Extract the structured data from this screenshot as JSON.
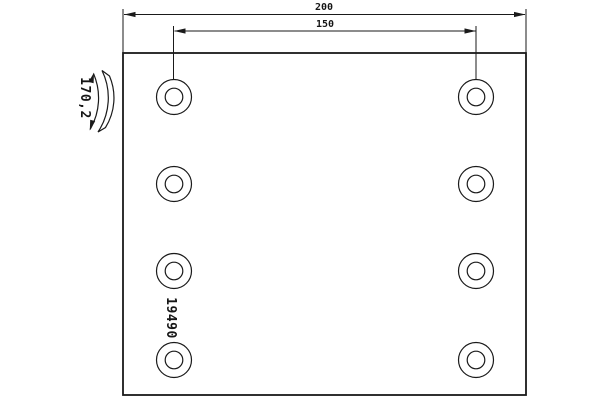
{
  "window": {
    "background": "#ffffff"
  },
  "drawing": {
    "line_color": "#1a1a1a",
    "labels": {
      "overall_width": "200",
      "hole_spacing": "150",
      "arc_length": "170,2",
      "part_number": "19490"
    },
    "plate": {
      "hole_count": 8,
      "hole_columns": 2,
      "hole_rows": 4
    }
  }
}
